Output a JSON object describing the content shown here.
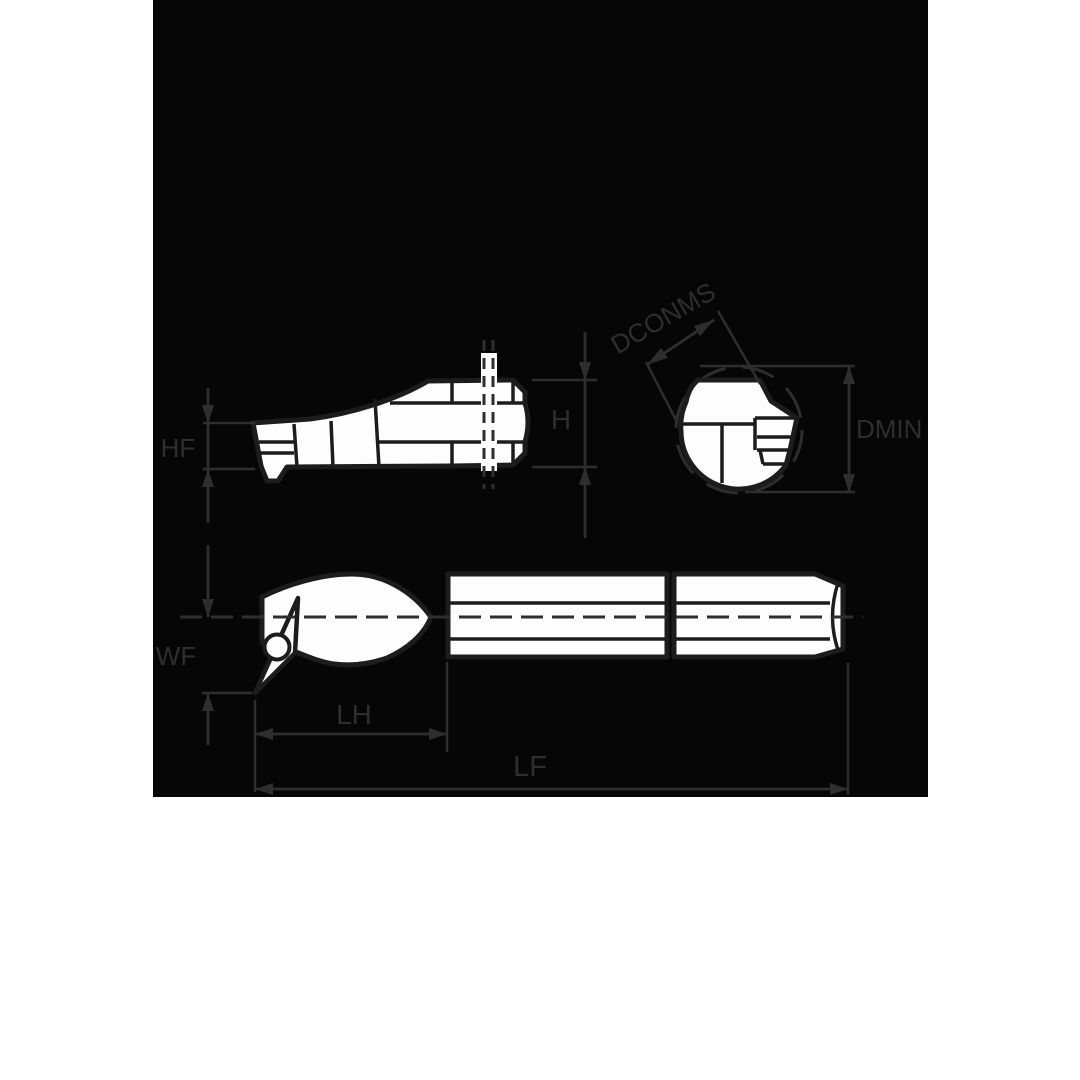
{
  "figure": {
    "type": "technical-drawing",
    "subject": "boring-bar-tool-holder",
    "views": 3
  },
  "labels": {
    "hf": "HF",
    "h": "H",
    "dconms": "DCONMS",
    "dmin": "DMIN",
    "wf": "WF",
    "lh": "LH",
    "lf": "LF"
  },
  "colors": {
    "page_bg": "#ffffff",
    "panel_bg": "#060606",
    "line": "#2e2e2e",
    "outline": "#1c1c1c",
    "fill": "#fdfdfd"
  }
}
